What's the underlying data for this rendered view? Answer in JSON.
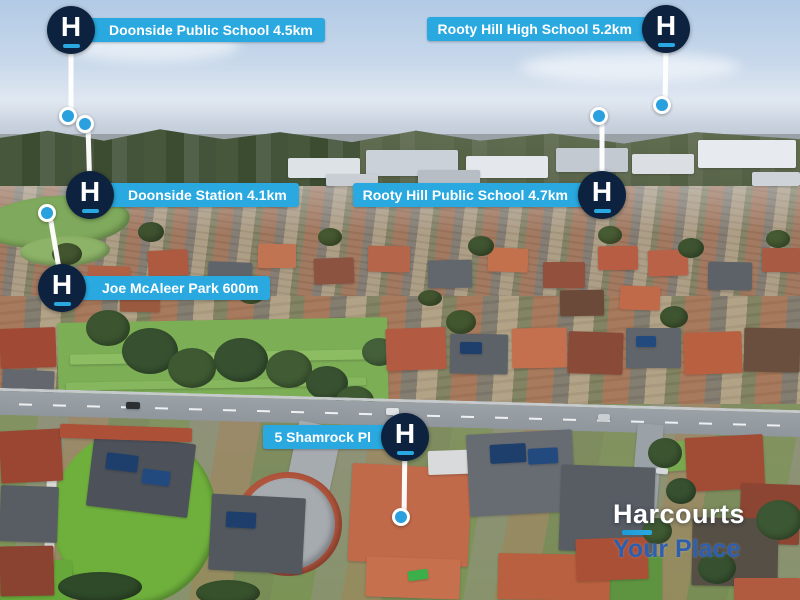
{
  "brand": {
    "wordmark": "Harcourts",
    "tagline": "Your Place",
    "badge_letter": "H"
  },
  "colors": {
    "label_blue": "#29a9e0",
    "badge_navy": "#0d223f",
    "pin_blue": "#2aa0de",
    "tagline_blue": "#2e5fae"
  },
  "markers": [
    {
      "id": "doonside-public-school",
      "label": "Doonside Public School 4.5km"
    },
    {
      "id": "rooty-hill-high-school",
      "label": "Rooty Hill High School 5.2km"
    },
    {
      "id": "doonside-station",
      "label": "Doonside Station 4.1km"
    },
    {
      "id": "rooty-hill-public-school",
      "label": "Rooty Hill Public School 4.7km"
    },
    {
      "id": "joe-mcaleer-park",
      "label": "Joe McAleer Park 600m"
    },
    {
      "id": "property-address",
      "label": "5 Shamrock Pl"
    }
  ]
}
